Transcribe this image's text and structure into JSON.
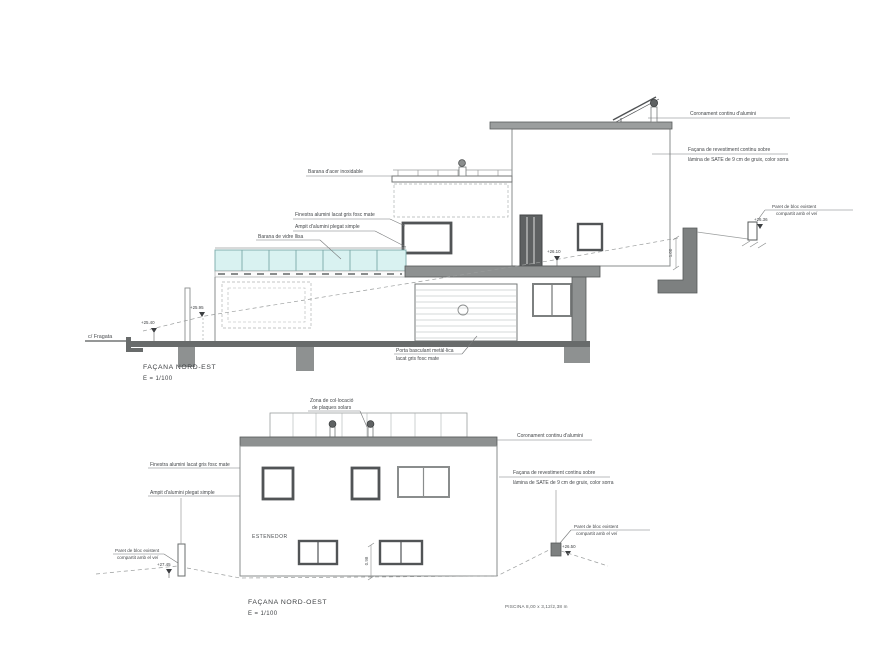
{
  "sheet": {
    "type": "architectural-elevations"
  },
  "colors": {
    "wall_dark": "#787b7b",
    "slab_gray": "#8e9191",
    "ground": "#686b6b",
    "glass": "#d9f2f1",
    "glass_line": "#7aa9a9",
    "outline": "#8a8d8d",
    "frame_dark": "#515456",
    "text": "#44474a"
  },
  "facade1": {
    "title": "FAÇANA NORD-EST",
    "scale": "E = 1/100",
    "street": "c/ Fragata",
    "labels": {
      "coronament": "Coronament continu d'alumini",
      "facana_line1": "Façana de revestiment continu sobre",
      "facana_line2": "làmina de SATE de 9 cm de gruix, color sorra",
      "barana_acer": "Barana d'acer inoxidable",
      "finestra": "Finestra alumini lacat gris fosc mate",
      "ampit": "Ampit d'alumini plegat simple",
      "barana_vidre": "Barana de vidre llisa",
      "porta_line1": "Porta basculant metàl·lica",
      "porta_line2": "lacat gris fosc mate",
      "paret_line1": "Paret de bloc existent",
      "paret_line2": "compartit amb el veí"
    },
    "elevations": {
      "street": "+25.40",
      "terrace": "+25.95",
      "mid": "+26.10",
      "neighbour": "+26.36"
    },
    "dimensions": {
      "wall": "1.00"
    }
  },
  "facade2": {
    "title": "FAÇANA NORD-OEST",
    "scale": "E = 1/100",
    "labels": {
      "zona_line1": "Zona de col·locació",
      "zona_line2": "de plaques solars",
      "coronament": "Coronament continu d'alumini",
      "facana_line1": "Façana de revestiment continu sobre",
      "facana_line2": "làmina de SATE de 9 cm de gruix, color sorra",
      "finestra": "Finestra alumini lacat gris fosc mate",
      "ampit": "Ampit d'alumini plegat simple",
      "estenedor": "ESTENEDOR",
      "paret_left_line1": "Paret de bloc existent",
      "paret_left_line2": "compartit amb el veí",
      "paret_right_line1": "Paret de bloc existent",
      "paret_right_line2": "compartit amb el veí"
    },
    "elevations": {
      "left": "+27.45",
      "right": "+26.50"
    },
    "dimensions": {
      "height": "0.98"
    },
    "note": "PISCINA 8,00 x 3,12/2,38 m"
  }
}
